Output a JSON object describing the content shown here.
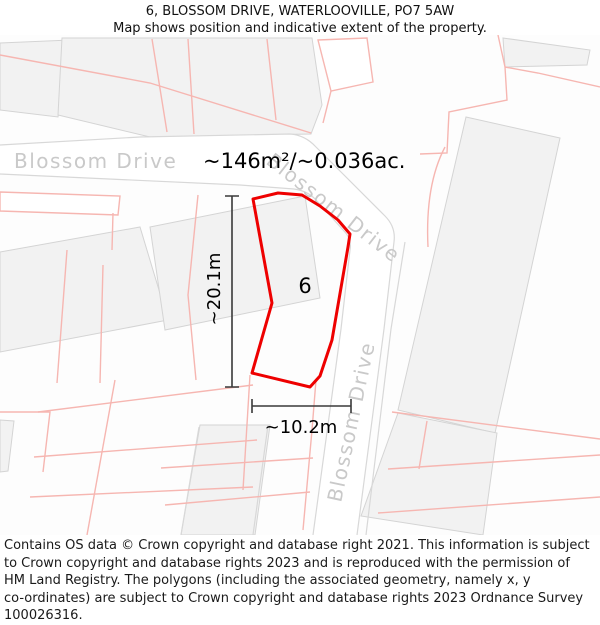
{
  "header": {
    "title": "6, BLOSSOM DRIVE, WATERLOOVILLE, PO7 5AW",
    "subtitle": "Map shows position and indicative extent of the property."
  },
  "map": {
    "area_label": "~146m²/~0.036ac.",
    "plot_number": "6",
    "road_labels": {
      "horizontal": "Blossom Drive",
      "diagonal": "Blossom Drive",
      "vertical": "Blossom Drive"
    },
    "dimensions": {
      "vertical": "~20.1m",
      "horizontal": "~10.2m"
    },
    "colors": {
      "property_outline": "#ee0000",
      "parcel_line": "#f6b6b1",
      "building_fill": "#f2f2f2",
      "road_edge": "#d8d8d8",
      "road_label": "#c9c9c9",
      "dimension_line": "#3a3a3a"
    }
  },
  "footer": {
    "line1": "Contains OS data © Crown copyright and database right 2021. This information is subject",
    "line2": "to Crown copyright and database rights 2023 and is reproduced with the permission of",
    "line3": "HM Land Registry. The polygons (including the associated geometry, namely x, y",
    "line4": "co-ordinates) are subject to Crown copyright and database rights 2023 Ordnance Survey",
    "line5": "100026316."
  }
}
